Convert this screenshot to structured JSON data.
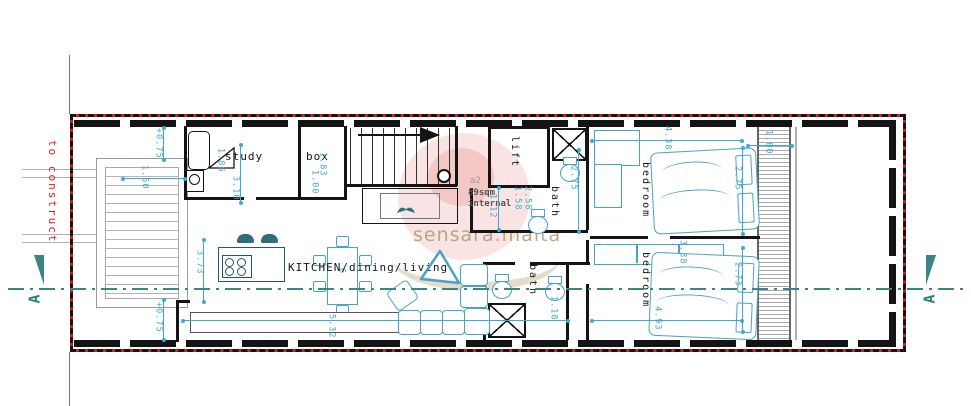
{
  "boundary": {
    "label": "to construct"
  },
  "watermark": {
    "text": "sensara.malta"
  },
  "area_tag": {
    "code": "a2",
    "area": "89sqm",
    "note": "internal"
  },
  "section": {
    "left": "A",
    "right": "A"
  },
  "rooms": {
    "study": "study",
    "box": "box",
    "lift": "lift",
    "bath_top": "bath",
    "bedroom_top": "bedroom",
    "bedroom_bottom": "bedroom",
    "bath_bottom": "bath",
    "kitchen_living": "KITCHEN/dining/living"
  },
  "dimensions": {
    "plus075_top": "+0.75",
    "w150": "1.50",
    "w186": "1.86",
    "w310": "3.10",
    "w183": "1.83",
    "w100_box": "1.00",
    "w373": "3.73",
    "plus075_bottom": "+0.75",
    "w532": "5.32",
    "w112": "1.12",
    "w158": "1.58",
    "w258": "2.58",
    "w275_bath": "2.75",
    "w438": "4.38",
    "w275_bed": "2.75",
    "w100_strip": "1.00",
    "w493": "4.93",
    "w273": "2.73",
    "w338": "3.38",
    "w118": "1.18",
    "table6": "6"
  },
  "colors": {
    "boundary_red": "#e01b15",
    "dimension_cyan": "#3fa9cf",
    "section_teal": "#3a8585",
    "wall_black": "#141414",
    "furniture_teal": "#4aa3c7",
    "stair_gray": "#9a9a9a",
    "watermark_tan": "#b29e78",
    "watermark_pink": "#e8b7b2"
  }
}
